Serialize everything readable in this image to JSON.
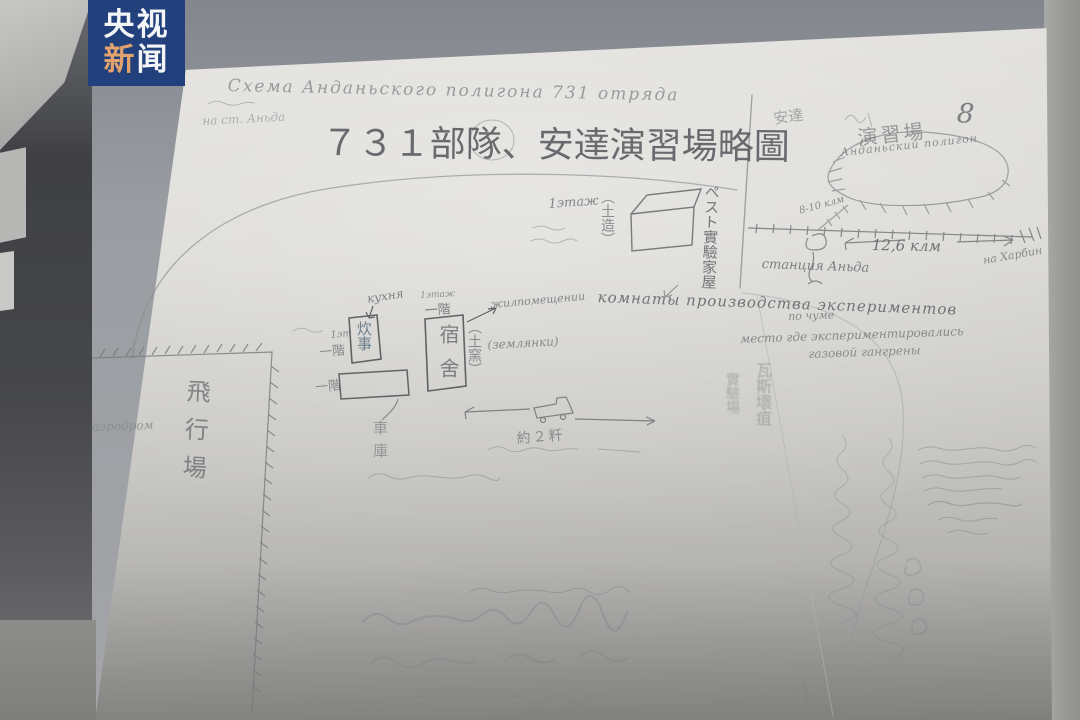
{
  "logo": {
    "line1": "央视",
    "line2_char1": "新",
    "line2_char2": "闻"
  },
  "page": {
    "number": "8",
    "title_ru": "Схема Анданьского полигона 731 отряда",
    "station_note_ru": "на ст. Аньда",
    "title_zh": "７３１部隊、安達演習場略圖"
  },
  "training_ground": {
    "name_zh_small": "安達",
    "name_zh": "演習場",
    "name_ru": "Анданьский полигон"
  },
  "railway": {
    "station_ru": "станция Аньда",
    "branch_ru": "8-10 клм",
    "distance_ru": "12,6 клм",
    "direction_ru": "на Харбин"
  },
  "experiment_house": {
    "floor_ru": "1этаж",
    "material_zh": "（土造）",
    "name_zh": "ペスト實驗家屋"
  },
  "kitchen": {
    "name_ru": "кухня",
    "name_zh": "炊事",
    "floor_ru": "1эт",
    "floor_zh": "一階"
  },
  "dormitory": {
    "name_zh": "宿舍",
    "floor_ru": "1этаж",
    "floor_zh": "一階",
    "dugout_zh": "（土窯）",
    "dugout_ru": "(землянки)",
    "quarters_ru": "жилпомещении"
  },
  "experiment_rooms": {
    "line1_ru": "комнаты производства экспериментов",
    "line2_ru": "по чуме"
  },
  "gangrene_site": {
    "line1_ru": "место где экспериментировались",
    "line2_ru": "газовой гангрены",
    "col1_zh": "瓦斯壞疽",
    "col2_zh": "實驗場"
  },
  "airfield": {
    "name_ru": "аэродром",
    "name_zh": "飛行場"
  },
  "garage": {
    "floor_zh": "一階",
    "name_zh": "車庫"
  },
  "route": {
    "distance_zh": "約２粁"
  },
  "colors": {
    "logo_blue": "#22407c",
    "logo_accent": "#e2a26d",
    "pencil": "#65676c",
    "paper": "#d9d8d4"
  }
}
